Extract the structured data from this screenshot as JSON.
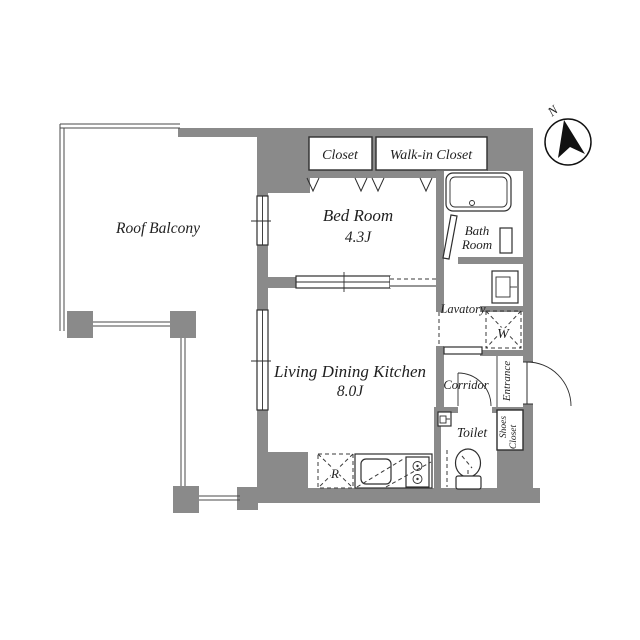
{
  "title": "Apartment floor plan",
  "labels": {
    "roof_balcony": "Roof Balcony",
    "closet": "Closet",
    "walk_in_closet": "Walk-in Closet",
    "bed_room": "Bed Room",
    "bed_room_size": "4.3J",
    "bath_line1": "Bath",
    "bath_line2": "Room",
    "lavatory": "Lavatory",
    "living_dining_kitchen": "Living Dining Kitchen",
    "ldk_size": "8.0J",
    "corridor": "Corridor",
    "entrance": "Entrance",
    "toilet": "Toilet",
    "shoes_line1": "Shoes",
    "shoes_line2": "Closet",
    "washing_machine": "W",
    "refrigerator": "R",
    "north": "N"
  },
  "colors": {
    "wall": "#8a8a8a",
    "line": "#2e2e2e",
    "text": "#1f1f1f",
    "railing": "#4a4a4a",
    "background": "#ffffff"
  }
}
